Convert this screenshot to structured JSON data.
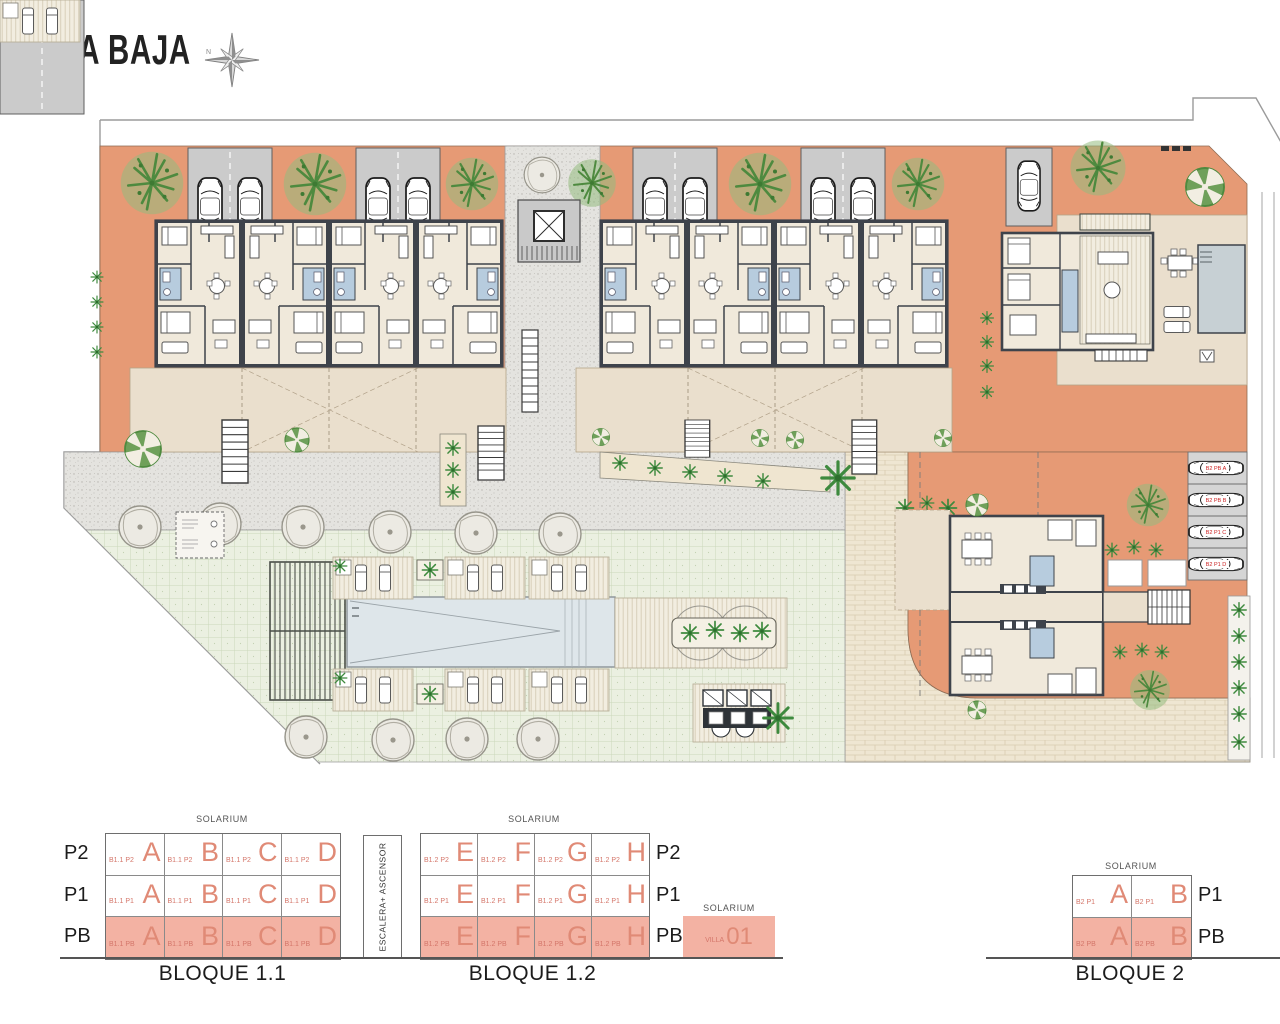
{
  "title": "PLANTA BAJA",
  "compass": {
    "north": "N"
  },
  "plan": {
    "bloque2_parking": [
      "B2 PB A",
      "B2 PB B",
      "B2 P1 C",
      "B2 P1 D"
    ]
  },
  "elevation": {
    "solarium": "SOLARIUM",
    "stairs": "ESCALERA+ ASCENSOR",
    "blocks": [
      {
        "name": "BLOQUE 1.1",
        "prefix": "B1.1",
        "floors": [
          "P2",
          "P1",
          "PB"
        ],
        "units": [
          "A",
          "B",
          "C",
          "D"
        ]
      },
      {
        "name": "BLOQUE 1.2",
        "prefix": "B1.2",
        "floors": [
          "P2",
          "P1",
          "PB"
        ],
        "units": [
          "E",
          "F",
          "G",
          "H"
        ]
      },
      {
        "name": "BLOQUE 2",
        "prefix": "B2",
        "floors": [
          "P1",
          "PB"
        ],
        "units": [
          "A",
          "B"
        ]
      }
    ],
    "villa": {
      "label": "VILLA",
      "number": "01"
    }
  }
}
